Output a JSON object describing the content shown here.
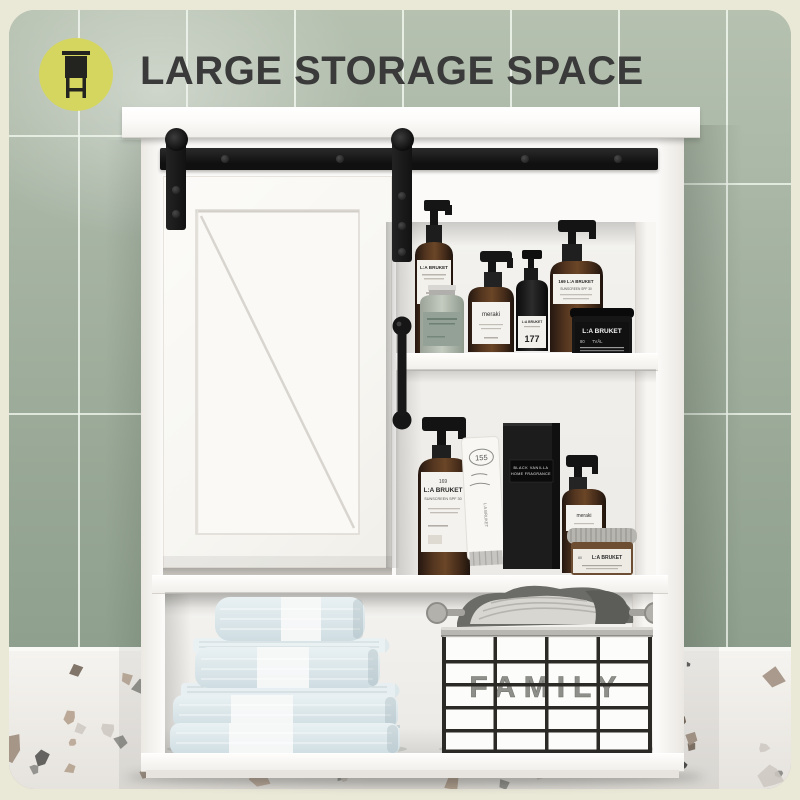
{
  "title": {
    "text": "LARGE STORAGE SPACE",
    "color": "#3a3a3a"
  },
  "badge": {
    "icon": "cabinet-icon",
    "circle_color": "#d5d660",
    "icon_color": "#23231f"
  },
  "scene": {
    "wall": {
      "tile_color": "#a7b4a4",
      "grout_color": "#f0f6ee"
    },
    "terrazzo": {
      "base_color": "#f1efeb",
      "chip_colors": [
        "#4a4a48",
        "#b7a492",
        "#cdc7c0",
        "#8e8e8a",
        "#6e5f52",
        "#a39384"
      ]
    },
    "cabinet_color": "#fbfaf8",
    "hardware_color": "#161616",
    "background_color": "#eae8d7"
  },
  "cabinet": {
    "type": "sliding barn door wall cabinet",
    "door_style": "white barn door with diagonal brace",
    "handle": "black pull handle",
    "rail": "black sliding rail with two hanger straps"
  },
  "products": {
    "top_shelf": [
      {
        "name": "tall-amber-pump-bottle",
        "brand_lines": [
          "L:A BRUKET"
        ]
      },
      {
        "name": "sage-glass-bottle",
        "brand_lines": []
      },
      {
        "name": "amber-pump-bottle",
        "brand_lines": [
          "meraki"
        ]
      },
      {
        "name": "black-pump-bottle",
        "brand_lines": [
          "L:A BRUKET",
          "177"
        ]
      },
      {
        "name": "tall-amber-sunscreen-bottle",
        "brand_lines": [
          "169  L:A BRUKET",
          "SUNSCREEN SPF 30"
        ]
      },
      {
        "name": "black-jar",
        "brand_lines": [
          "L:A BRUKET",
          "80",
          "TVÅL"
        ]
      }
    ],
    "middle_shelf": [
      {
        "name": "large-amber-sunscreen-bottle",
        "brand_lines": [
          "169",
          "L:A BRUKET",
          "SUNSCREEN SPF 30"
        ]
      },
      {
        "name": "white-tube",
        "brand_lines": [
          "155",
          "L:A BRUKET"
        ]
      },
      {
        "name": "black-fragrance-box",
        "brand_lines": [
          "BLACK VANILLA",
          "HOME FRAGRANCE"
        ]
      },
      {
        "name": "small-amber-pump-bottle",
        "brand_lines": [
          "meraki"
        ]
      },
      {
        "name": "amber-jar-silver-lid",
        "brand_lines": [
          "L:A BRUKET",
          "80"
        ]
      }
    ],
    "bottom_shelf": {
      "towels": {
        "count": 4,
        "description": "light blue folded towels with white stripe"
      },
      "basket": {
        "label": "FAMILY",
        "contents": "folded grey knitwear"
      }
    }
  }
}
